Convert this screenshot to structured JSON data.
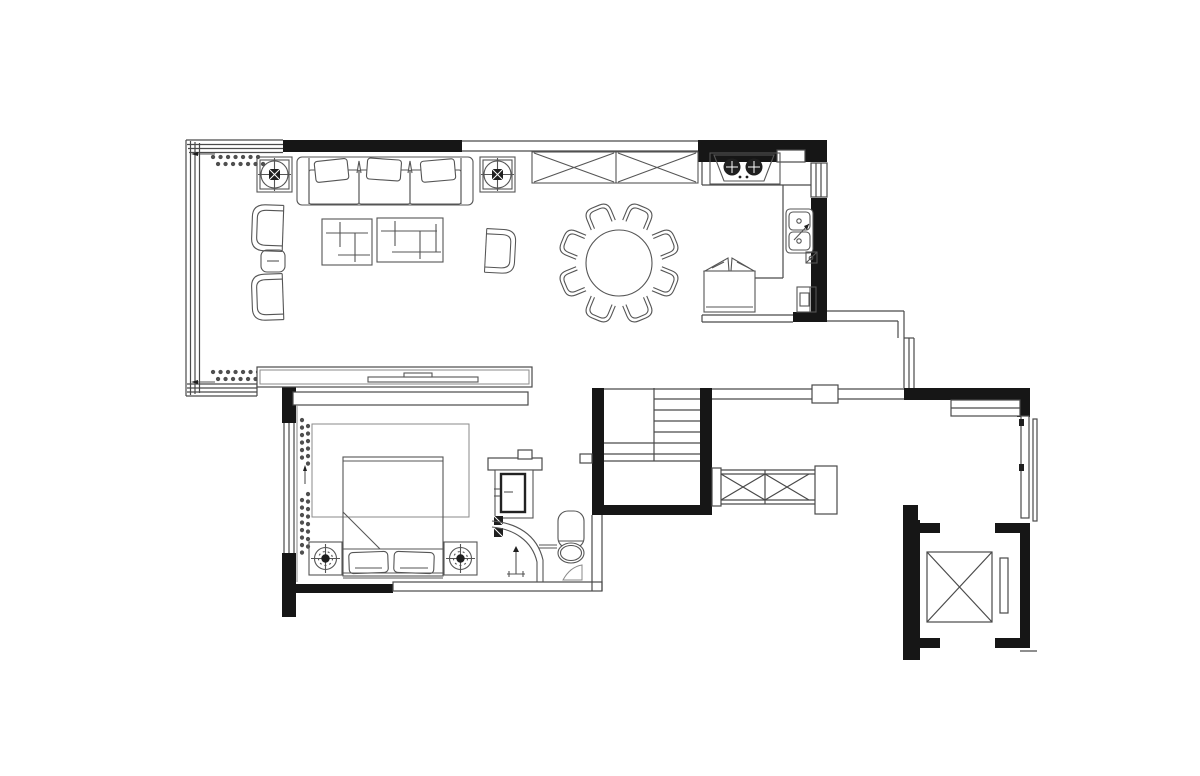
{
  "canvas": {
    "width": 1200,
    "height": 776,
    "background_color": "#ffffff"
  },
  "palette": {
    "wall_fill": "#161616",
    "structure_line": "#4a4a4a",
    "furniture_line": "#555555",
    "light_line": "#8a8a8a",
    "paper": "#ffffff"
  },
  "plan": {
    "type": "residential-floor-plan",
    "drawing_style": "CAD line drawing, no text labels",
    "rooms": [
      {
        "id": "living-room",
        "furniture": [
          "three-seat-sofa",
          "throw-pillows",
          "armchair-left-upper",
          "armchair-left-lower",
          "round-side-table",
          "coffee-table-small",
          "coffee-table-large",
          "accent-chair",
          "ceiling-fan-symbol-left",
          "ceiling-fan-symbol-right",
          "tv-console",
          "tv",
          "curtain-dots",
          "glazed-window-wall"
        ]
      },
      {
        "id": "dining-area",
        "furniture": [
          "round-dining-table",
          "dining-chairs-count-8",
          "x-front-storage-cabinet"
        ]
      },
      {
        "id": "kitchen",
        "furniture": [
          "two-burner-gas-cooktop",
          "counter",
          "double-bowl-sink",
          "faucet-arrow",
          "refrigerator-with-door-swing",
          "floor-drain",
          "water-heater-box",
          "side-window"
        ]
      },
      {
        "id": "bedroom",
        "furniture": [
          "double-bed",
          "turned-blanket-fold",
          "pillow-left",
          "pillow-right",
          "area-rug",
          "bedside-lamp-left",
          "bedside-lamp-right",
          "curtain-dots",
          "window-wall-left"
        ]
      },
      {
        "id": "bathroom",
        "furniture": [
          "vanity-with-mirror-cabinet",
          "supply-valves",
          "curved-glass-shower-screen",
          "floor-tap",
          "toilet",
          "small-shelf",
          "bath-mat"
        ]
      },
      {
        "id": "stairwell",
        "furniture": [
          "u-shaped-staircase",
          "x-brace-guard-railing",
          "railing-posts"
        ]
      },
      {
        "id": "foyer-corridor",
        "furniture": [
          "short-window",
          "entry-door-recess",
          "sliding-door-leaf",
          "black-column"
        ]
      },
      {
        "id": "elevator",
        "furniture": [
          "elevator-car-x-symbol",
          "elevator-door-slot",
          "shaft-walls"
        ]
      }
    ],
    "wall_segments_black_count": 19,
    "dining_chairs": 8,
    "stove_burners": 2,
    "sink_bowls": 2
  }
}
